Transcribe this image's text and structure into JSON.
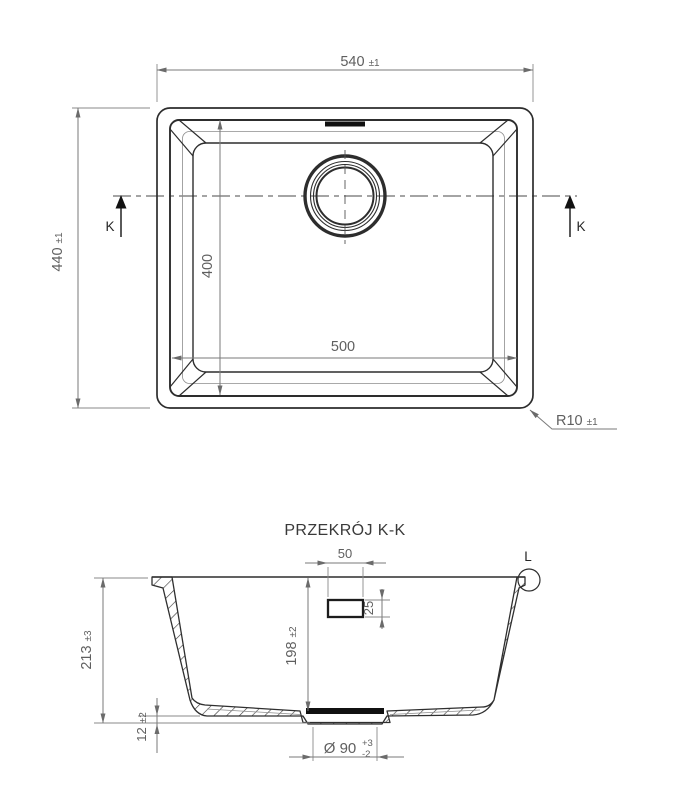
{
  "top_view": {
    "dim_width": {
      "value": "540",
      "tol": "±1"
    },
    "dim_height": {
      "value": "440",
      "tol": "±1"
    },
    "dim_inner_width": {
      "value": "500"
    },
    "dim_inner_height": {
      "value": "400"
    },
    "dim_corner_radius": {
      "value": "R10",
      "tol": "±1"
    },
    "section_label_left": "K",
    "section_label_right": "K"
  },
  "section_view": {
    "title": "PRZEKRÓJ K-K",
    "dim_total_height": {
      "value": "213",
      "tol": "±3"
    },
    "dim_depth": {
      "value": "198",
      "tol": "±2"
    },
    "dim_overflow_width": {
      "value": "50"
    },
    "dim_overflow_height": {
      "value": "25"
    },
    "dim_bottom_step": {
      "value": "12",
      "tol": "±2"
    },
    "dim_drain": {
      "value": "Ø 90",
      "tol_plus": "+3",
      "tol_minus": "-2"
    },
    "detail_label": "L"
  },
  "colors": {
    "outline": "#2d2d2d",
    "dim_line": "#7a7a7a",
    "dim_text": "#5f5f5f",
    "background": "#ffffff"
  }
}
